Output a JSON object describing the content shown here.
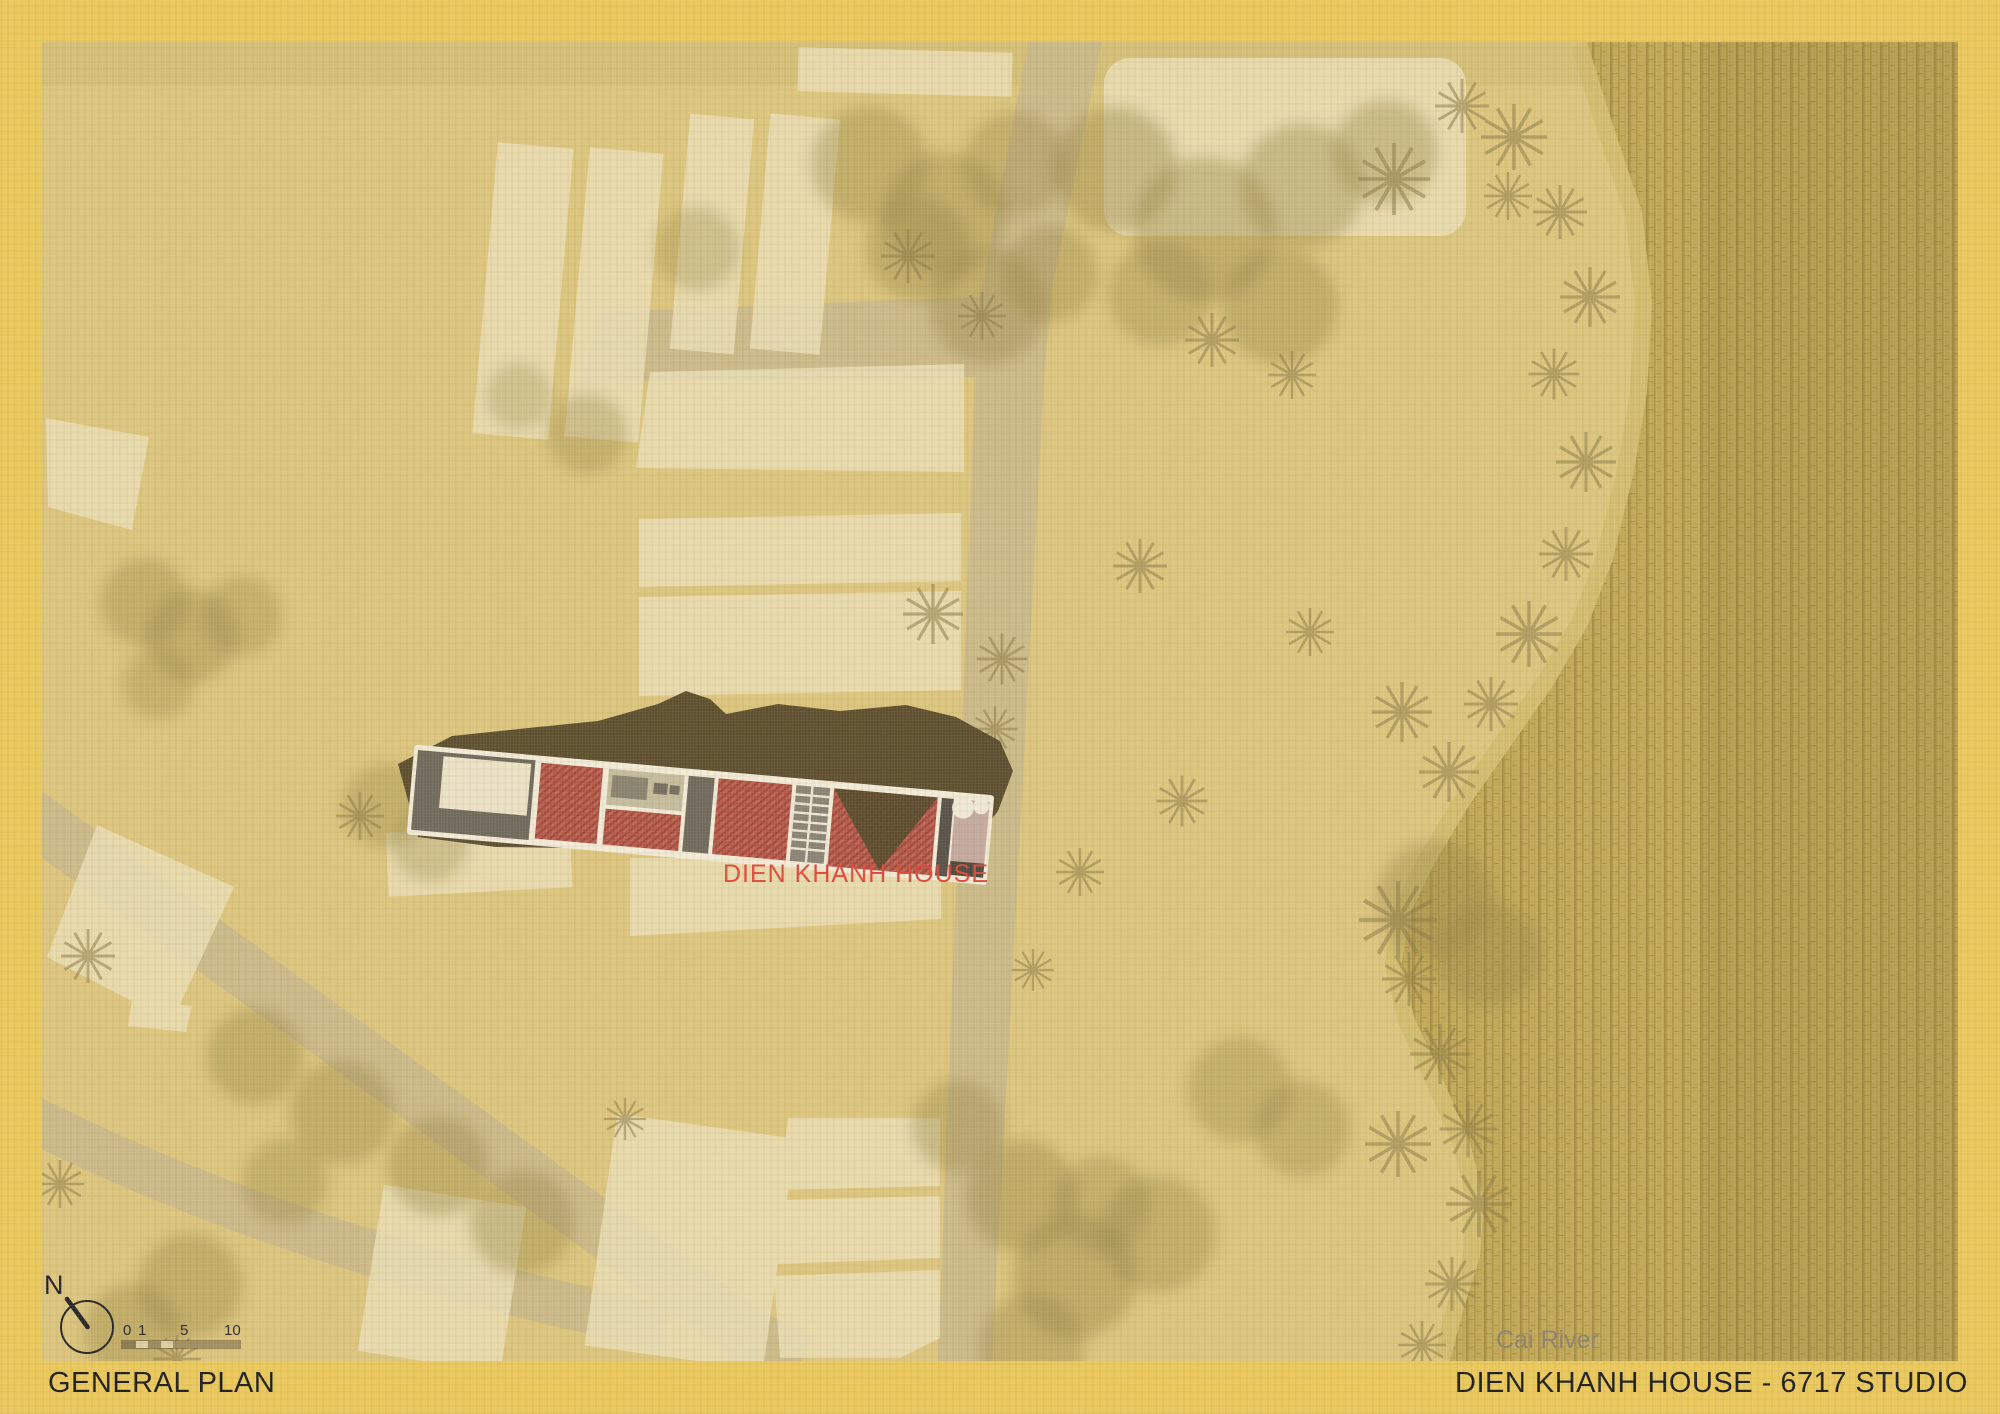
{
  "sheet": {
    "bottom_bar": {
      "drawing_title": "GENERAL PLAN",
      "project_credit": "DIEN KHANH HOUSE - 6717 STUDIO"
    },
    "map": {
      "house_label": "DIEN KHANH HOUSE",
      "river_label": "Cai River",
      "compass": {
        "north_label": "N"
      },
      "scale_bar": {
        "ticks": [
          "0",
          "1",
          "5",
          "10"
        ]
      }
    },
    "colors": {
      "frame_yellow": "#eac85c",
      "field_tan": "#dcc57e",
      "plot_cream": "#eadfb6",
      "road_beige": "#c7b78d",
      "river_olive": "#c2a958",
      "tree_olive": "#998748",
      "roof_dark": "#574b2d",
      "room_red": "#b5584a",
      "house_label_red": "#e2483a",
      "river_label_gray": "#8b8370",
      "ink": "#1e1e1e"
    }
  }
}
